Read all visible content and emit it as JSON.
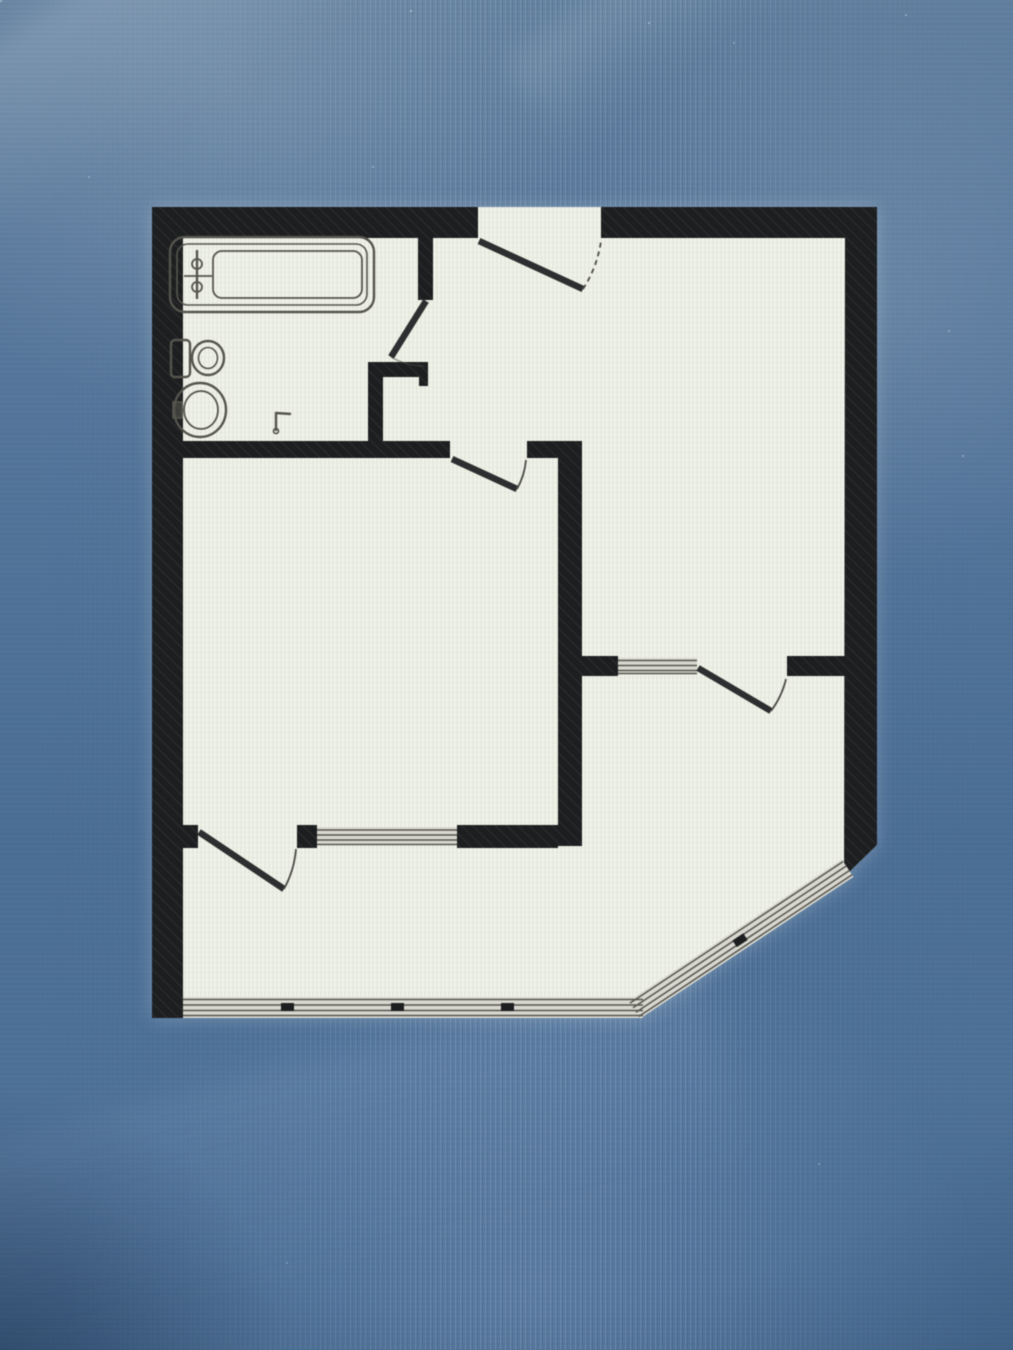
{
  "colors": {
    "screen_top": "#62809f",
    "screen_mid": "#4c6f96",
    "screen_bottom": "#476a90",
    "paper": "#f1f2ea",
    "paper_stripe": "#cdd9c6",
    "wall": "#1c1e20",
    "wall_hatch": "#34373a",
    "window_glass": "#d8d8d0",
    "window_frame": "#55554e",
    "door_leaf": "#2d2e2f",
    "door_arc": "#4c4c47",
    "fixture_outline": "#55544d"
  },
  "floor_plan": {
    "shape": "rectangular apartment outline with chamfered glazed bottom-right corner",
    "fixtures": [
      {
        "icon": "bathtub-icon"
      },
      {
        "icon": "bathtub-tap-icon"
      },
      {
        "icon": "toilet-icon"
      },
      {
        "icon": "washbasin-icon"
      },
      {
        "icon": "tap-icon"
      }
    ],
    "doors": [
      {
        "icon": "entrance-door-swing"
      },
      {
        "icon": "bathroom-door-swing"
      },
      {
        "icon": "living-room-door-swing"
      },
      {
        "icon": "balcony-door-swing"
      },
      {
        "icon": "loggia-door-swing"
      }
    ],
    "windows": [
      {
        "icon": "living-room-window"
      },
      {
        "icon": "room-loggia-window"
      },
      {
        "icon": "loggia-glazing-bottom"
      },
      {
        "icon": "loggia-glazing-chamfer"
      }
    ]
  }
}
